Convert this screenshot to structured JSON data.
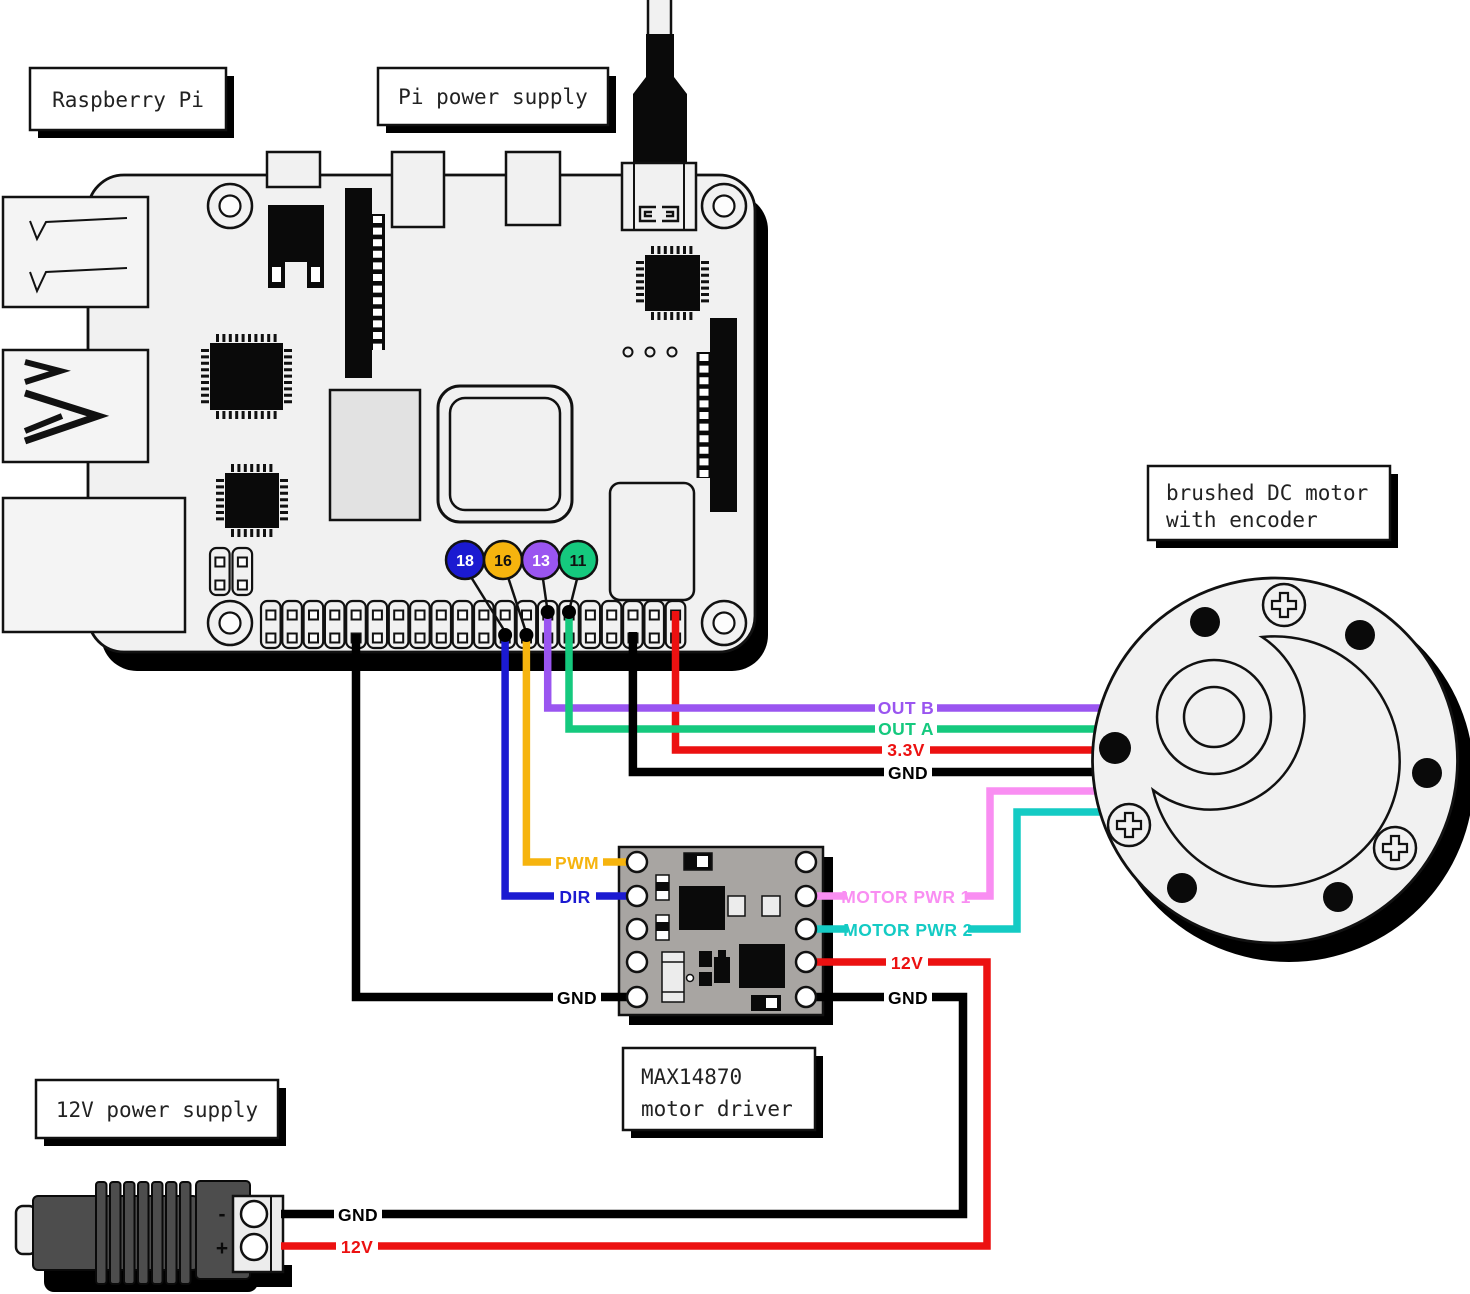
{
  "title_boxes": {
    "raspberry_pi": "Raspberry Pi",
    "pi_power_supply": "Pi power supply",
    "motor_line1": "brushed DC motor",
    "motor_line2": "with encoder",
    "driver_line1": "MAX14870",
    "driver_line2": "motor driver",
    "supply_12v": "12V power supply"
  },
  "gpio_badges": [
    {
      "label": "18",
      "color": "#1b1ad1",
      "text_color": "#ffffff"
    },
    {
      "label": "16",
      "color": "#f6b40e",
      "text_color": "#111111"
    },
    {
      "label": "13",
      "color": "#9a55f0",
      "text_color": "#ffffff"
    },
    {
      "label": "11",
      "color": "#15c97e",
      "text_color": "#111111"
    }
  ],
  "wire_labels": {
    "out_b": "OUT B",
    "out_a": "OUT A",
    "v3_3": "3.3V",
    "gnd": "GND",
    "pwm": "PWM",
    "dir": "DIR",
    "motor_pwr_1": "MOTOR PWR 1",
    "motor_pwr_2": "MOTOR PWR 2",
    "v12": "12V"
  },
  "power_supply_12v": {
    "terminal_minus": "-",
    "terminal_plus": "+"
  },
  "colors": {
    "wire_blue": "#1b1ad1",
    "wire_orange": "#f6b40e",
    "wire_purple": "#9a55f0",
    "wire_green": "#15c97e",
    "wire_red": "#ec1111",
    "wire_pink": "#f98ef2",
    "wire_cyan": "#14cbc4",
    "wire_black": "#000000",
    "board_light": "#f1f1f1",
    "driver_board": "#a8a5a2",
    "supply_body": "#4d4d4d"
  }
}
